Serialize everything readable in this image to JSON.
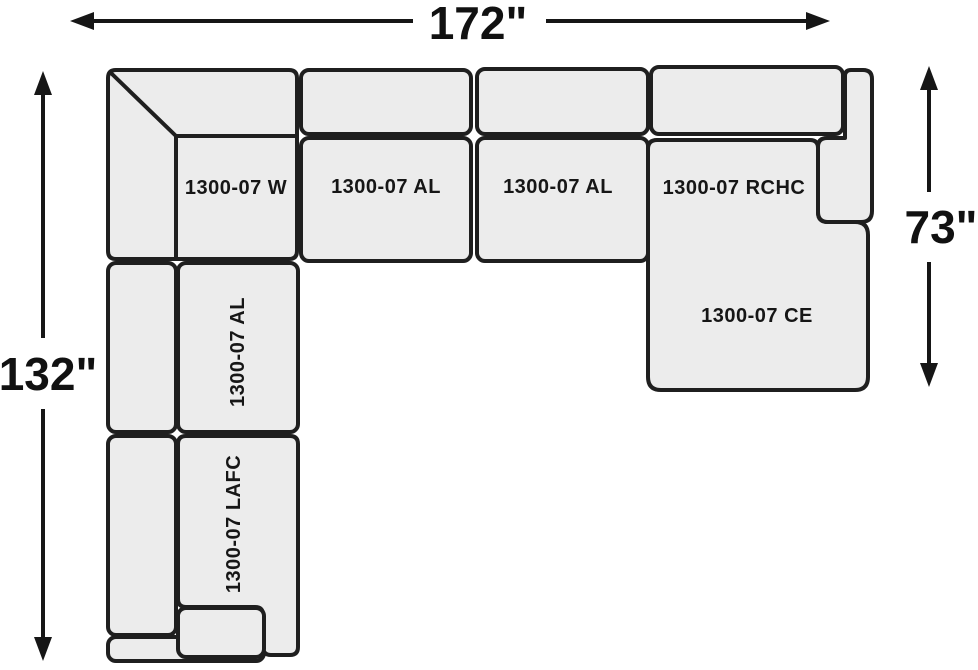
{
  "dimensions": {
    "width": "172\"",
    "height": "132\"",
    "right_height": "73\""
  },
  "pieces": {
    "wedge": "1300-07 W",
    "armless_top_1": "1300-07 AL",
    "armless_top_2": "1300-07 AL",
    "right_chaise": "1300-07 RCHC",
    "chaise_extension": "1300-07 CE",
    "armless_left": "1300-07 AL",
    "left_arm_facing_chaise": "1300-07 LAFC"
  },
  "colors": {
    "piece_fill": "#ececec",
    "piece_border": "#1f1f1f",
    "dimension_color": "#161616",
    "background": "#ffffff"
  }
}
